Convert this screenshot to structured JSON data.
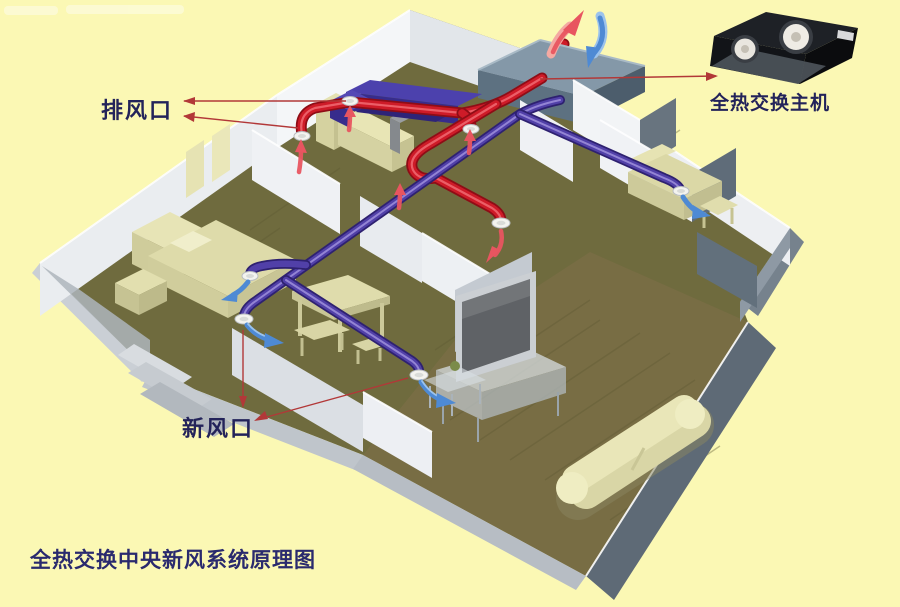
{
  "diagram": {
    "caption": "全热交换中央新风系统原理图",
    "labels": {
      "exhaust_vent": "排风口",
      "fresh_air_vent": "新风口",
      "main_unit": "全热交换主机"
    },
    "colors": {
      "page_bg": "#FBF8B4",
      "label_text": "#23235A",
      "caption_text": "#2A2A6E",
      "exhaust_duct": "#CE1B28",
      "exhaust_duct_dark": "#8E0D16",
      "exhaust_duct_light": "#F06A72",
      "fresh_duct": "#5140A8",
      "fresh_duct_dark": "#2E2170",
      "fresh_duct_light": "#9A8CD8",
      "exhaust_arrow": "#E85560",
      "fresh_arrow": "#4E8AD4",
      "leader": "#B23838",
      "floor_olive": "#6F6B3E",
      "floor_brown": "#786D44",
      "wall_light": "#EDEFF2",
      "wall_shadow": "#C7CCD3",
      "slate_wall": "#5E6A76",
      "roof_unit_top": "#8498A8",
      "roof_unit_front": "#5D7181",
      "furniture_cream": "#DBD8A6",
      "sofa_purple": "#4C41AD"
    }
  }
}
